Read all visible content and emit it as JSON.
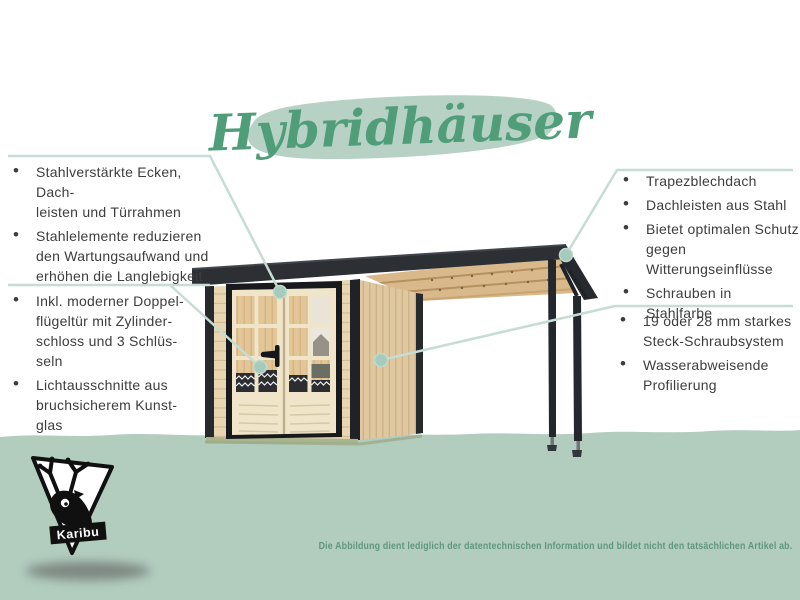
{
  "title": {
    "text": "Hybridhäuser"
  },
  "panels": {
    "left_top": {
      "items": [
        "Stahlverstärkte Ecken, Dach-\nleisten und Türrahmen",
        "Stahlelemente reduzieren\nden Wartungsaufwand und\nerhöhen die Langlebigkeit"
      ]
    },
    "left_bottom": {
      "items": [
        "Inkl. moderner Doppel-\nflügeltür mit Zylinder-\nschloss und 3 Schlüs-\nseln",
        "Lichtausschnitte aus\nbruchsicherem Kunst-\nglas"
      ]
    },
    "right_top": {
      "items": [
        "Trapezblechdach",
        "Dachleisten aus Stahl",
        "Bietet optimalen Schutz\ngegen Witterungseinflüsse",
        "Schrauben in Stahlfarbe"
      ]
    },
    "right_bottom": {
      "items": [
        "19 oder 28 mm starkes\nSteck-Schraubsystem",
        "Wasserabweisende\nProfilierung"
      ]
    }
  },
  "logo": {
    "brand": "Karibu"
  },
  "footer": {
    "disclaimer": "Die Abbildung dient lediglich der datentechnischen Information und bildet nicht den tatsächlichen Artikel ab."
  },
  "illustration": {
    "name": "gartenhaus-mit-anbaudach"
  },
  "colors": {
    "title_green": "#4f9e79",
    "brush_green": "#b7d2c4",
    "ground_green": "#b2ccbe",
    "line_teal": "#c6ddd3",
    "dot_teal": "#a5cbbc",
    "body_text": "#3d3d3d",
    "roof_dark": "#2c2f34",
    "wood_front": "#e8d5b1",
    "wood_side": "#dfc79f",
    "door_cream": "#f0e5c8",
    "disclaimer_green": "#5f977d"
  }
}
